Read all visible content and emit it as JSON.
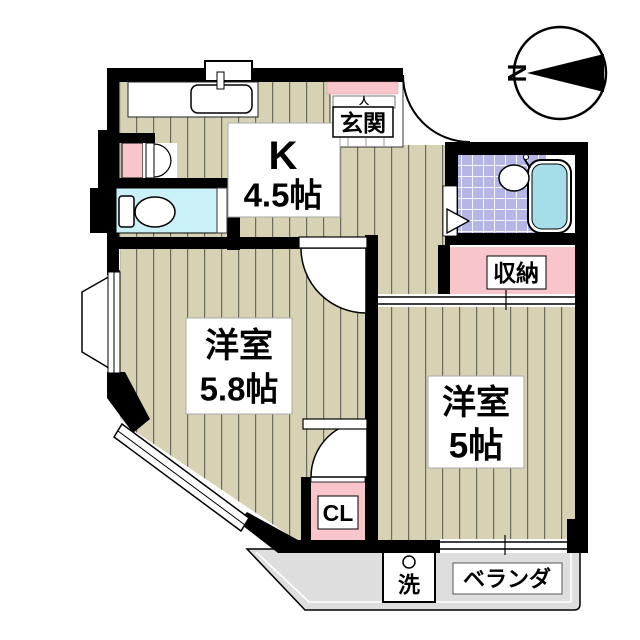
{
  "plan": {
    "type": "japanese-apartment-floor-plan",
    "compass_n": "N",
    "kitchen": {
      "label": "K",
      "size": "4.5帖"
    },
    "entrance": {
      "mark": "人",
      "label": "玄関"
    },
    "room_58": {
      "label": "洋室",
      "size": "5.8帖"
    },
    "room_5": {
      "label": "洋室",
      "size": "5帖"
    },
    "storage": {
      "label": "収納"
    },
    "closet": {
      "label": "CL"
    },
    "washer": {
      "label": "洗"
    },
    "veranda": {
      "label": "ベランダ"
    }
  },
  "colors": {
    "wall": "#000000",
    "flooring": "#d8d2b4",
    "flooring_line": "#6a6a5d",
    "pink_storage": "#f8c6ca",
    "toilet_floor": "#c9f1f7",
    "bath_tile": "#b6b6e6",
    "bathtub_water": "#a5dde8",
    "veranda_gray": "#dedede",
    "background": "#ffffff"
  }
}
